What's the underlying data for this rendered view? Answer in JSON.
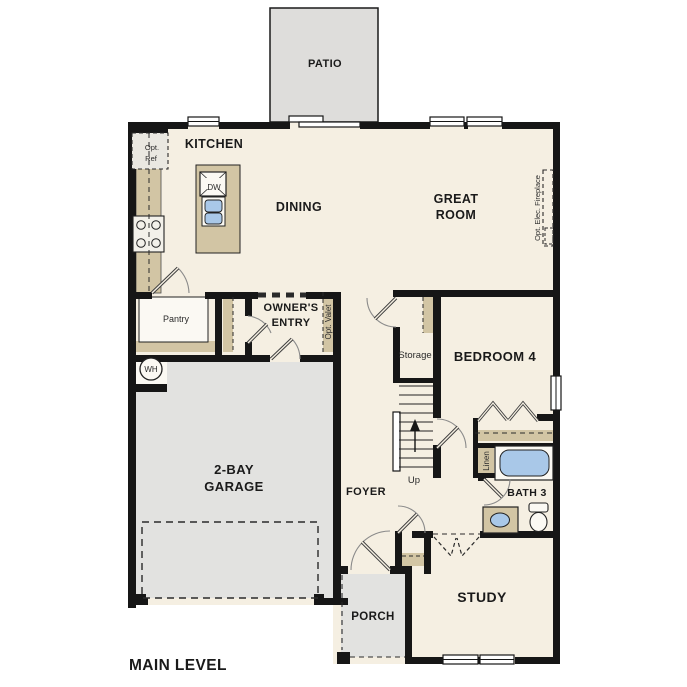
{
  "plan_title": "MAIN LEVEL",
  "rooms": {
    "patio": "PATIO",
    "kitchen": "KITCHEN",
    "dining": "DINING",
    "great_room": [
      "GREAT",
      "ROOM"
    ],
    "owners_entry": [
      "OWNER'S",
      "ENTRY"
    ],
    "pantry": "Pantry",
    "storage": "Storage",
    "bedroom_4": "BEDROOM 4",
    "garage": [
      "2-BAY",
      "GARAGE"
    ],
    "foyer": "FOYER",
    "bath_3": "BATH 3",
    "study": "STUDY",
    "porch": "PORCH"
  },
  "annotations": {
    "opt_ref": [
      "Opt.",
      "Ref"
    ],
    "opt_valet": "Opt. Valet",
    "opt_elec_fireplace": "Opt. Elec. Fireplace",
    "linen": "Linen",
    "dishwasher": "DW",
    "water_heater": "WH",
    "stairs_up": "Up"
  },
  "colors": {
    "wall": "#161616",
    "floor": "#f5efe2",
    "cabinet_tan": "#d2c5a4",
    "outdoor_gray": "#e2e2e0",
    "fixture_blue": "#a9c8e8",
    "background": "#ffffff"
  }
}
